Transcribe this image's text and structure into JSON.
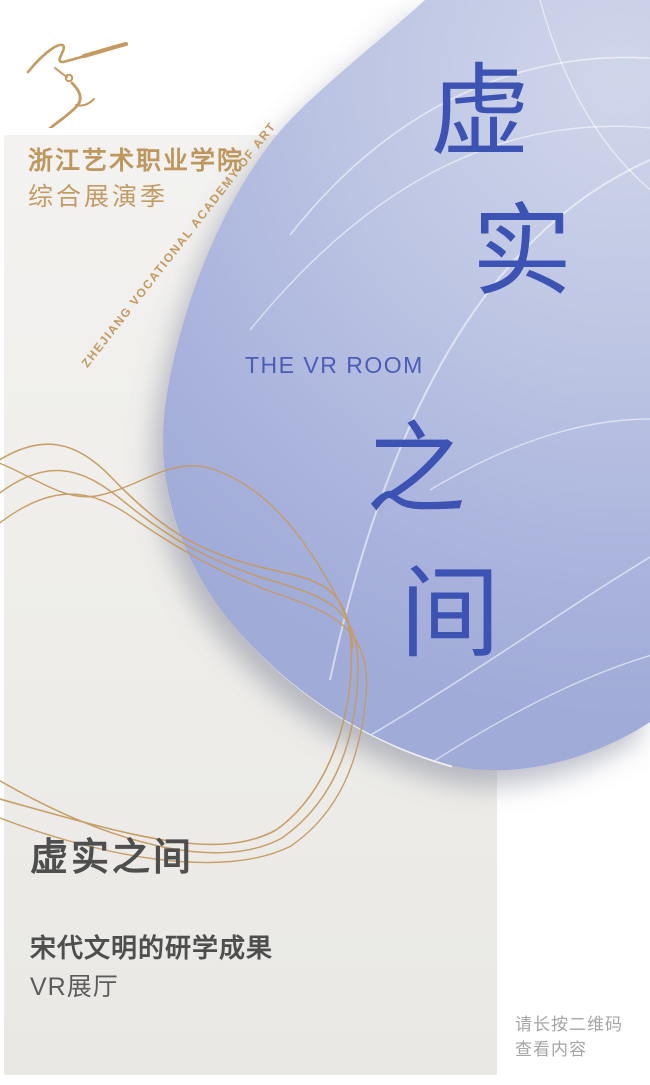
{
  "header": {
    "logo": "dancer-crane-logo",
    "academy_name": "浙江艺术职业学院",
    "season_title": "综合展演季",
    "rotated_caption": "ZHEJIANG VOCATIONAL ACADEMY OF ART"
  },
  "hero": {
    "title_chars": [
      "虚",
      "实",
      "之",
      "间"
    ],
    "subtitle_en": "THE VR ROOM"
  },
  "footer": {
    "title": "虚实之间",
    "subtitle": "宋代文明的研学成果",
    "venue": "VR展厅",
    "qr_hint": [
      "请长按二维码",
      "查看内容"
    ]
  },
  "colors": {
    "gold": "#C49B63",
    "gold_text": "#BE975F",
    "title_blue": "#3D53B3",
    "blob_blue_light": "#D0D6EA",
    "blob_blue_dark": "#A0ABD7",
    "panel_gray": "#EFEEEB",
    "heading_gray": "#4E4E4E",
    "hint_gray": "#A5A5A5"
  }
}
